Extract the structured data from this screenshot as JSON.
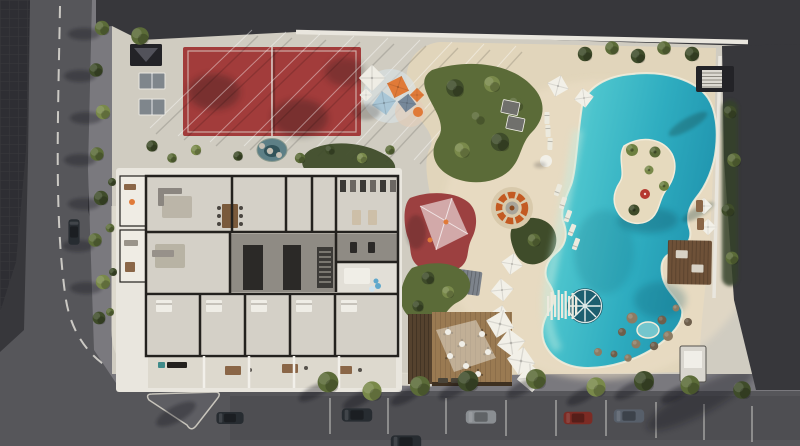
{
  "meta": {
    "title": "Aerial architectural rendering of residential amenity site",
    "description": "Top-down 3D render: paddle court with shade cables, table tennis, kids playground with colorful canopies, winding garden paths, lagoon-style pool with palm island and round swim-up lounge, rock spa grotto, beach with white pyramid umbrellas and loungers, wooden beach-club deck, cutaway residential floor plan with gym and terraces, bordered by streets with parked cars and trees."
  },
  "scene": {
    "features": [
      "paddle-court",
      "table-tennis",
      "entry-canopy",
      "garden-pond",
      "kids-playground",
      "net-shade-sail",
      "planting-islands",
      "lagoon-pool",
      "pool-island",
      "swim-wheel-lounge",
      "slat-boardwalk",
      "rock-spa",
      "beach-umbrellas",
      "sun-loungers",
      "fire-pit-lounge",
      "cabanas",
      "pergola-deck",
      "beach-club-deck",
      "residential-floor-plan",
      "gym",
      "street-parking",
      "paver-plaza"
    ]
  },
  "colors": {
    "asphalt_dark": "#37373b",
    "asphalt_road": "#56565a",
    "plaza_pavers": "#2e2e33",
    "sidewalk_gray": "#7a797e",
    "curb_light": "#c8c5bc",
    "path_concrete": "#d0ccc1",
    "walkway_light": "#ddd9ce",
    "sand": "#e1d5bb",
    "sand_light": "#ecdfc7",
    "court_red": "#a23c3b",
    "playground_red": "#9c4040",
    "canopy_orange": "#e07a38",
    "canopy_blue": "#a9c6d6",
    "canopy_white": "#efede5",
    "canopy_slate": "#76889a",
    "fire_orange": "#c35a22",
    "umbrella_white": "#f2f0e8",
    "cabana_gray": "#70706c",
    "lounger_white": "#eceade",
    "green_dark": "#3f4c2a",
    "green_mid": "#5b6b38",
    "green_light": "#79894a",
    "palm_green": "#6d8040",
    "hedge_dark": "#35422a",
    "roof_white": "#e9e6de",
    "floor_light": "#d4d0c7",
    "floor_mid": "#c3bfb5",
    "floor_dark": "#8f8b84",
    "wall_dark": "#23211e",
    "core_dark": "#2b2927",
    "wood_furniture": "#8a6647",
    "table_brown": "#7a5a3b",
    "wood_deck": "#9a7a52",
    "wood_deck_dark": "#55422e",
    "pergola_brown": "#6e5138",
    "rock_tan": "#8c7b63",
    "rock_dark": "#6e5f4c",
    "spa_blue": "#74c6cd",
    "wheel_teal": "#1d5f70",
    "water_pond": "#5d7f86",
    "island_sand": "#e6dabe",
    "building_small": "#d9d6cf",
    "structure_dark": "#232327",
    "ball_blue": "#5fa8cc",
    "teal_cart": "#3f8b8a",
    "umbrella_red": "#b5392f",
    "car_dark": "#272c31",
    "car_silver": "#8a8e92",
    "car_red": "#7c2b24",
    "car_blue": "#575f6a",
    "line_white": "#e8e6df",
    "pool_edge_cream": "#f2ecda"
  }
}
